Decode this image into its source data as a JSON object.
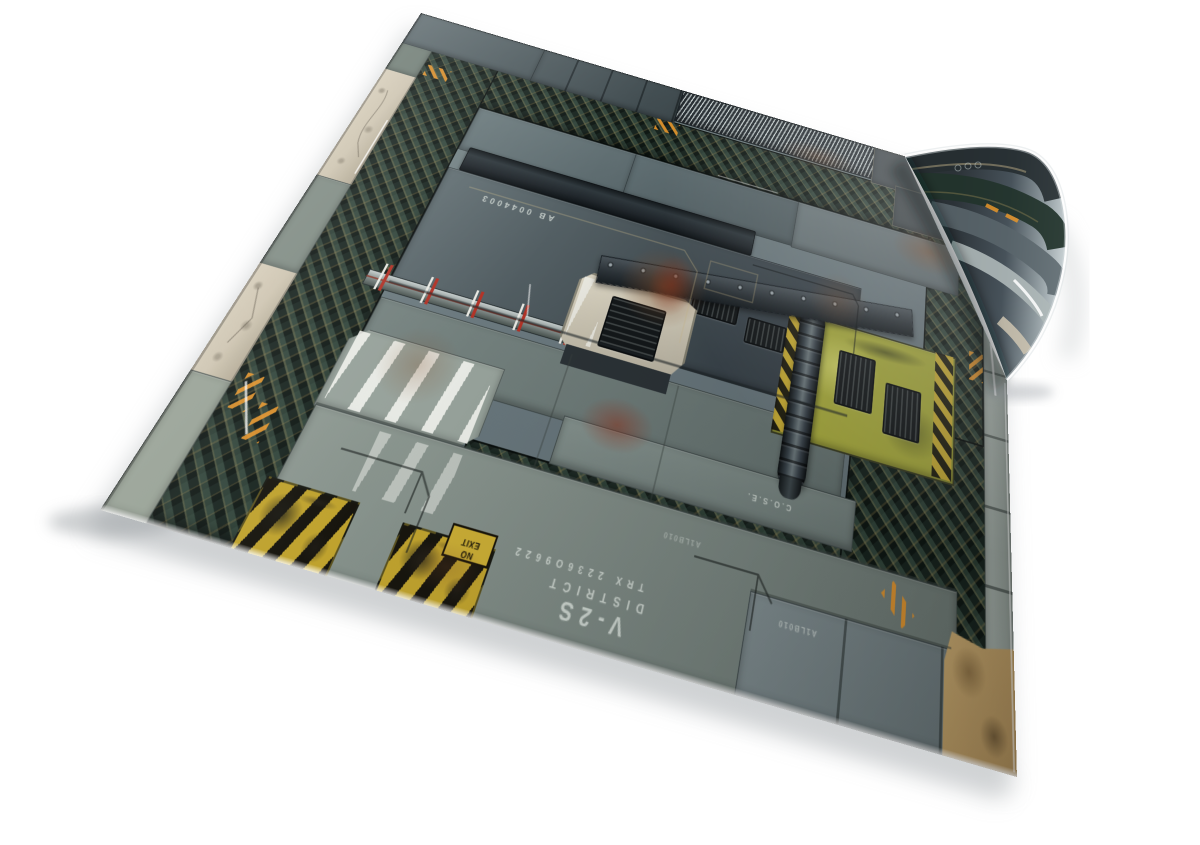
{
  "scene": {
    "type": "product-photo",
    "subject": "Sci-fi industrial wargaming battle mat lying on a white background, viewed in perspective with its far right corner curled upward",
    "background_color": "#ffffff",
    "shadow_color": "#b9bdc0"
  },
  "mat": {
    "theme": "weathered spaceship deck plates with teal diamond-plate roads and hazard markings",
    "labels": {
      "no_exit_line1": "NO",
      "no_exit_line2": "EXIT",
      "serial_code": "TRX 2236O9622",
      "district_line1": "V-2S",
      "district_line2": "DISTRICT",
      "panel_code": "AB 0044003",
      "code_small": "A1LB010",
      "code_dotted": "C.O.S.E."
    },
    "colors": {
      "road_teal": "#18241f",
      "plate_grey": "#76858a",
      "plate_light": "#97a29c",
      "deck_dark": "#343c41",
      "marble_beige": "#cdc4b0",
      "console_cream": "#ddd7c5",
      "panel_yellow_green": "#a6a93d",
      "hazard_yellow": "#c9ac35",
      "hazard_black": "#17150e",
      "accent_orange": "#e8962a",
      "marker_red": "#b03226",
      "rust_brown": "#7e4e2c",
      "stencil_white": "#e4ebe5"
    }
  }
}
